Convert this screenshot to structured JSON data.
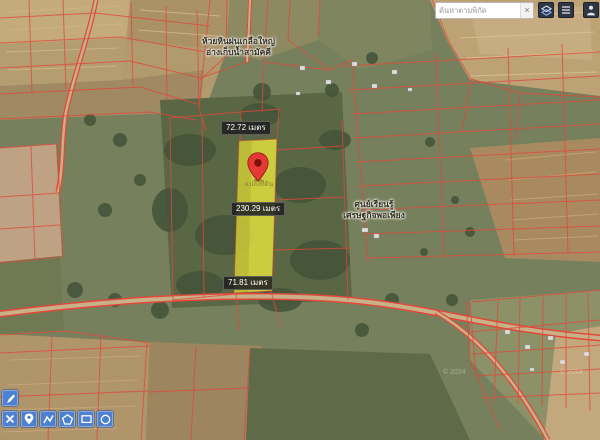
{
  "search": {
    "placeholder": "ค้นหาตามพิกัด",
    "clear_label": "×"
  },
  "topbar": {
    "buttons": [
      {
        "name": "layers",
        "icon": "layers-icon"
      },
      {
        "name": "list",
        "icon": "list-icon"
      },
      {
        "name": "person",
        "icon": "person-icon"
      }
    ]
  },
  "toolbar": {
    "edit_button": {
      "name": "edit",
      "icon": "pen-icon"
    },
    "buttons": [
      {
        "name": "delete",
        "icon": "x-icon"
      },
      {
        "name": "marker",
        "icon": "pin-icon"
      },
      {
        "name": "polyline",
        "icon": "polyline-icon"
      },
      {
        "name": "polygon",
        "icon": "polygon-icon"
      },
      {
        "name": "rectangle",
        "icon": "rectangle-icon"
      },
      {
        "name": "circle",
        "icon": "circle-icon"
      }
    ]
  },
  "measurements": {
    "top_width": "72.72 เมตร",
    "length": "230.29 เมตร",
    "bottom_width": "71.81 เมตร"
  },
  "map_labels": {
    "village": {
      "line1": "ห้วยหินฝนเกลือใหญ่",
      "line2": "อ่างเก็บน้ำสามัคคี"
    },
    "learning_center": {
      "line1": "ศูนย์เรียนรู้",
      "line2": "เศรษฐกิจพอเพียง"
    },
    "parcel_note": "แปลงที่ดิน",
    "imagery_watermark": "© 2024"
  },
  "colors": {
    "cadastral_line": "#e0493b",
    "parcel_highlight": "#e9e63f",
    "marker_pin": "#e53935",
    "toolbar_button": "#4d80cf",
    "topbar_button": "#2e3744"
  }
}
